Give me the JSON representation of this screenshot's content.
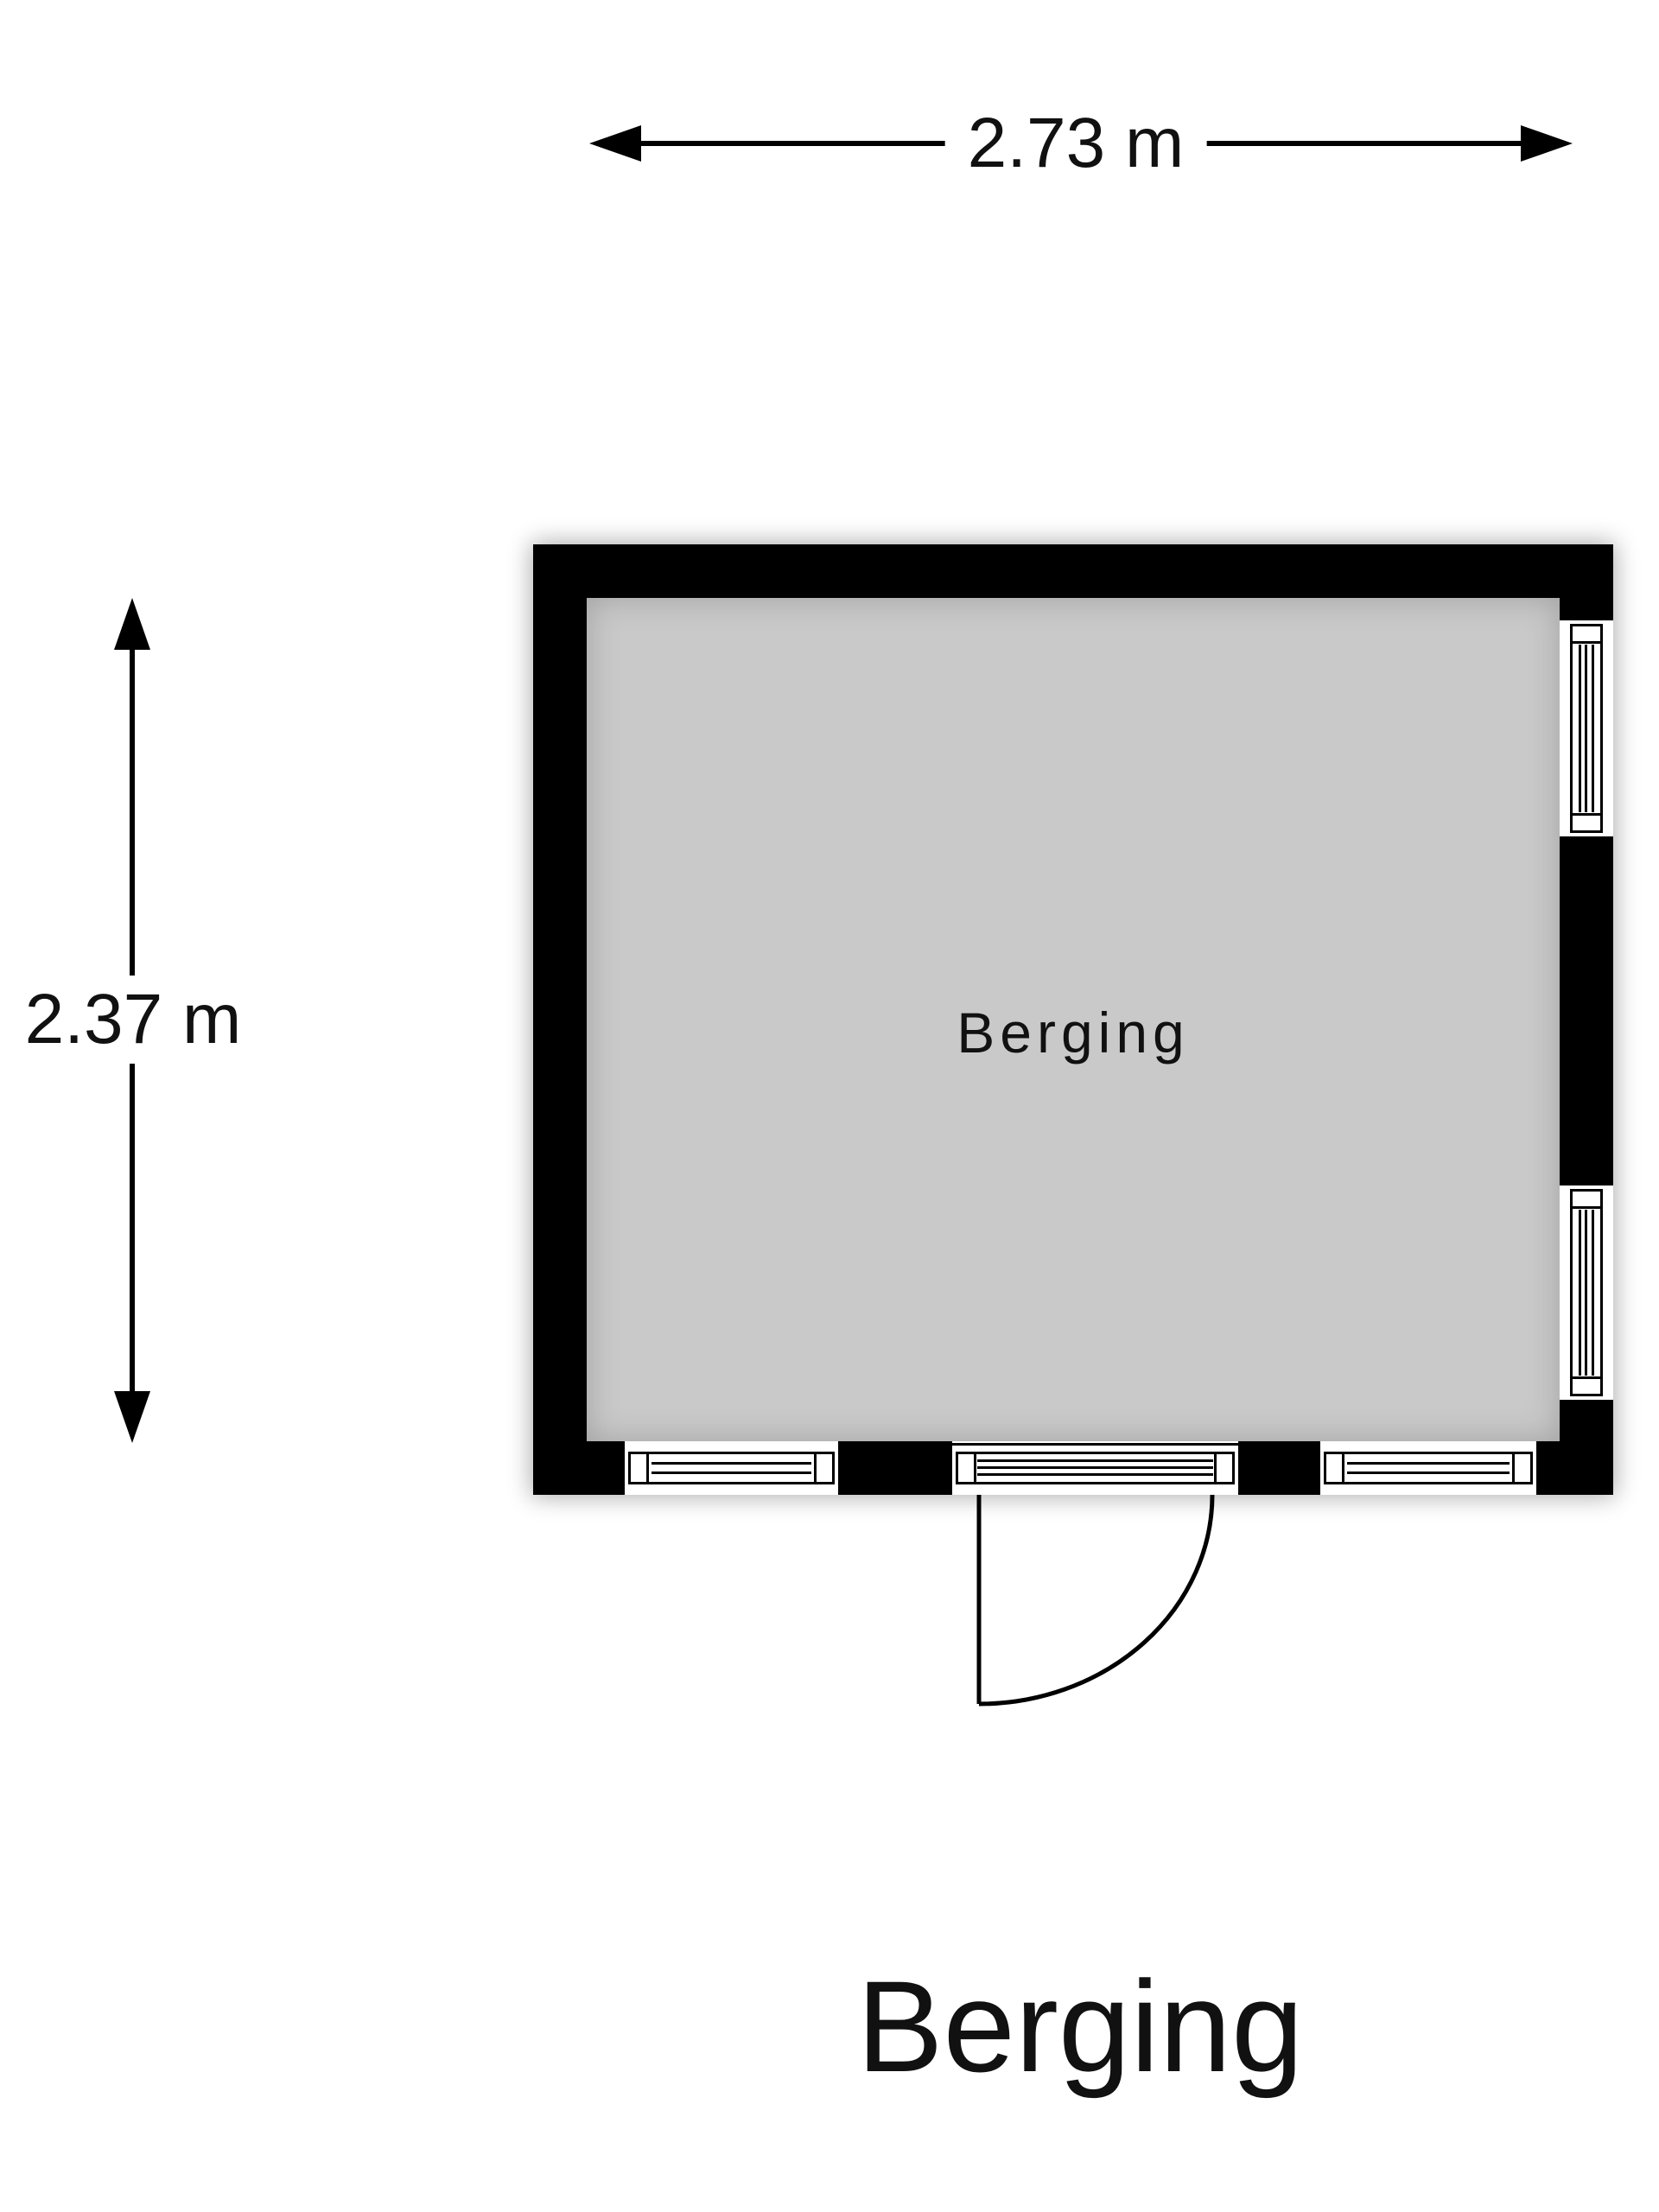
{
  "floorplan": {
    "room_label": "Berging",
    "title": "Berging",
    "dim_width": "2.73 m",
    "dim_height": "2.37 m"
  },
  "features": {
    "windows": [
      "right-wall-top",
      "right-wall-bottom",
      "bottom-wall-left",
      "bottom-wall-right"
    ],
    "doors": [
      "bottom-wall-center-swing-inward... outward quarter-arc"
    ]
  },
  "colors": {
    "wall": "#000000",
    "floor": "#c9c9c9",
    "background": "#ffffff",
    "line": "#000000",
    "text": "#111111"
  }
}
